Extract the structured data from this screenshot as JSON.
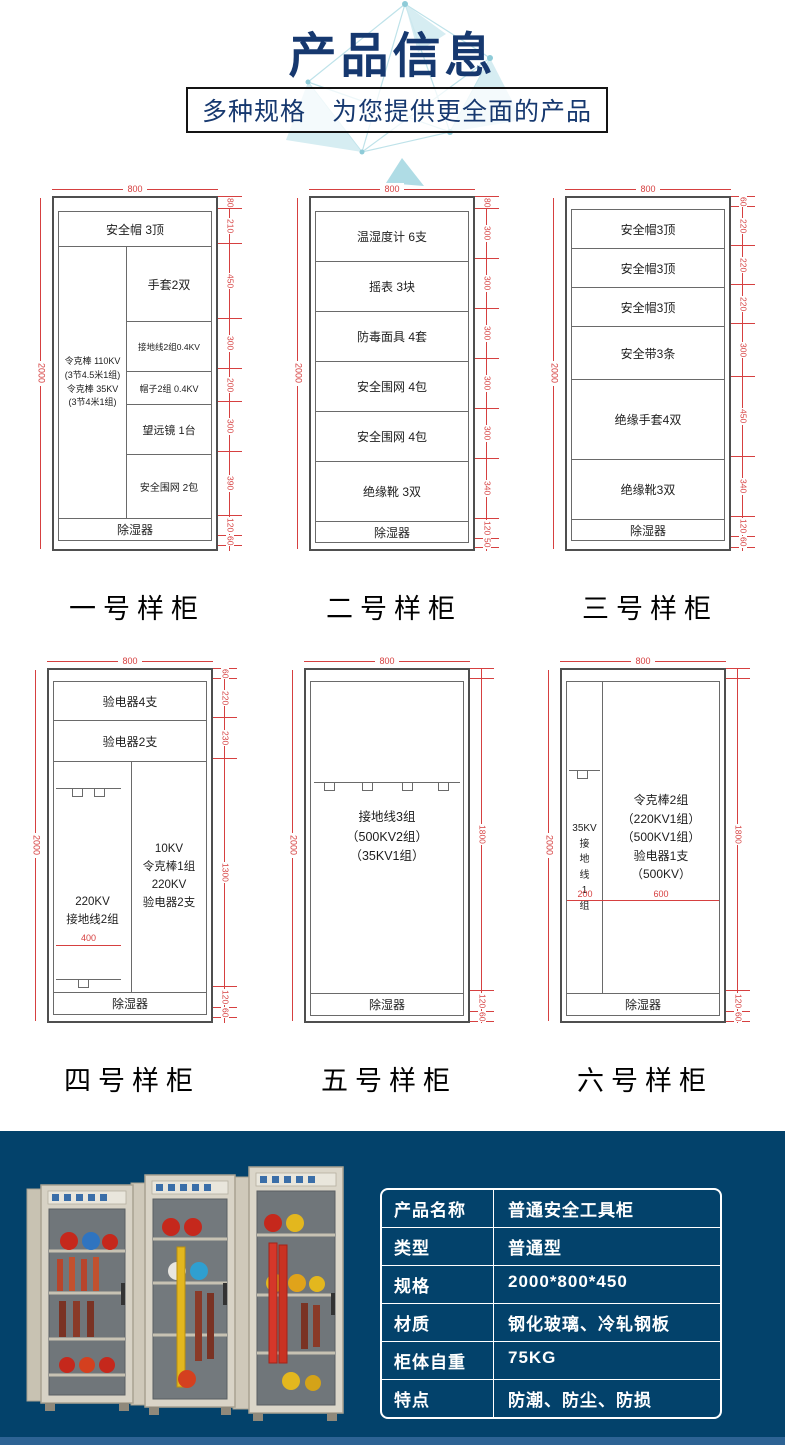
{
  "colors": {
    "navy_background": "#03426b",
    "title_blue": "#16386f",
    "dimension_red": "#d64040",
    "deco_teal": "#cfeaf0"
  },
  "header": {
    "title": "产品信息",
    "subtitle": "多种规格　为您提供更全面的产品"
  },
  "cabinets": {
    "c1": {
      "top_dim": "800",
      "side_dim": "2000",
      "s_hat": "安全帽  3顶",
      "left_col": "令克棒  110KV\n(3节4.5米1组)\n令克棒  35KV\n(3节4米1组)",
      "r1": "手套2双",
      "r2": "接地线2组0.4KV",
      "r3": "帽子2组 0.4KV",
      "r4": "望远镜  1台",
      "r5": "安全围网  2包",
      "bottom": "除湿器",
      "d": [
        "80",
        "210",
        "450",
        "300",
        "200",
        "300",
        "390",
        "120",
        "60"
      ],
      "label": "一号样柜"
    },
    "c2": {
      "top_dim": "800",
      "side_dim": "2000",
      "s1": "温湿度计  6支",
      "s2": "摇表  3块",
      "s3": "防毒面具  4套",
      "s4": "安全围网  4包",
      "s5": "安全围网  4包",
      "s6": "绝缘靴  3双",
      "bottom": "除湿器",
      "d": [
        "80",
        "300",
        "300",
        "300",
        "300",
        "300",
        "340",
        "120",
        "50"
      ],
      "label": "二号样柜"
    },
    "c3": {
      "top_dim": "800",
      "side_dim": "2000",
      "s1": "安全帽3顶",
      "s2": "安全帽3顶",
      "s3": "安全帽3顶",
      "s4": "安全带3条",
      "s5": "绝缘手套4双",
      "s6": "绝缘靴3双",
      "bottom": "除湿器",
      "d": [
        "60",
        "220",
        "220",
        "220",
        "300",
        "450",
        "340",
        "120",
        "60"
      ],
      "label": "三号样柜"
    },
    "c4": {
      "top_dim": "800",
      "side_dim": "2000",
      "s1": "验电器4支",
      "s2": "验电器2支",
      "left_col": "220KV\n接地线2组",
      "right_col": "10KV\n令克棒1组\n220KV\n验电器2支",
      "inner_dim": "400",
      "bottom": "除湿器",
      "d": [
        "60",
        "220",
        "230",
        "1300",
        "120",
        "60"
      ],
      "label": "四号样柜"
    },
    "c5": {
      "top_dim": "800",
      "side_dim": "2000",
      "main": "接地线3组\n（500KV2组）\n（35KV1组）",
      "bottom": "除湿器",
      "d": [
        "1800",
        "120",
        "60"
      ],
      "label": "五号样柜"
    },
    "c6": {
      "top_dim": "800",
      "side_dim": "2000",
      "left_col": "35KV\n接\n地\n线\n1\n组",
      "right_col": "令克棒2组\n（220KV1组）\n（500KV1组）\n验电器1支\n（500KV）",
      "dim_left_col": "200",
      "dim_right_col": "600",
      "bottom": "除湿器",
      "d": [
        "1800",
        "120",
        "60"
      ],
      "label": "六号样柜"
    }
  },
  "spec_table": {
    "rows": [
      {
        "label": "产品名称",
        "value": "普通安全工具柜"
      },
      {
        "label": "类型",
        "value": "普通型"
      },
      {
        "label": "规格",
        "value": "2000*800*450"
      },
      {
        "label": "材质",
        "value": "钢化玻璃、冷轧钢板"
      },
      {
        "label": "柜体自重",
        "value": "75KG"
      },
      {
        "label": "特点",
        "value": "防潮、防尘、防损"
      }
    ]
  }
}
